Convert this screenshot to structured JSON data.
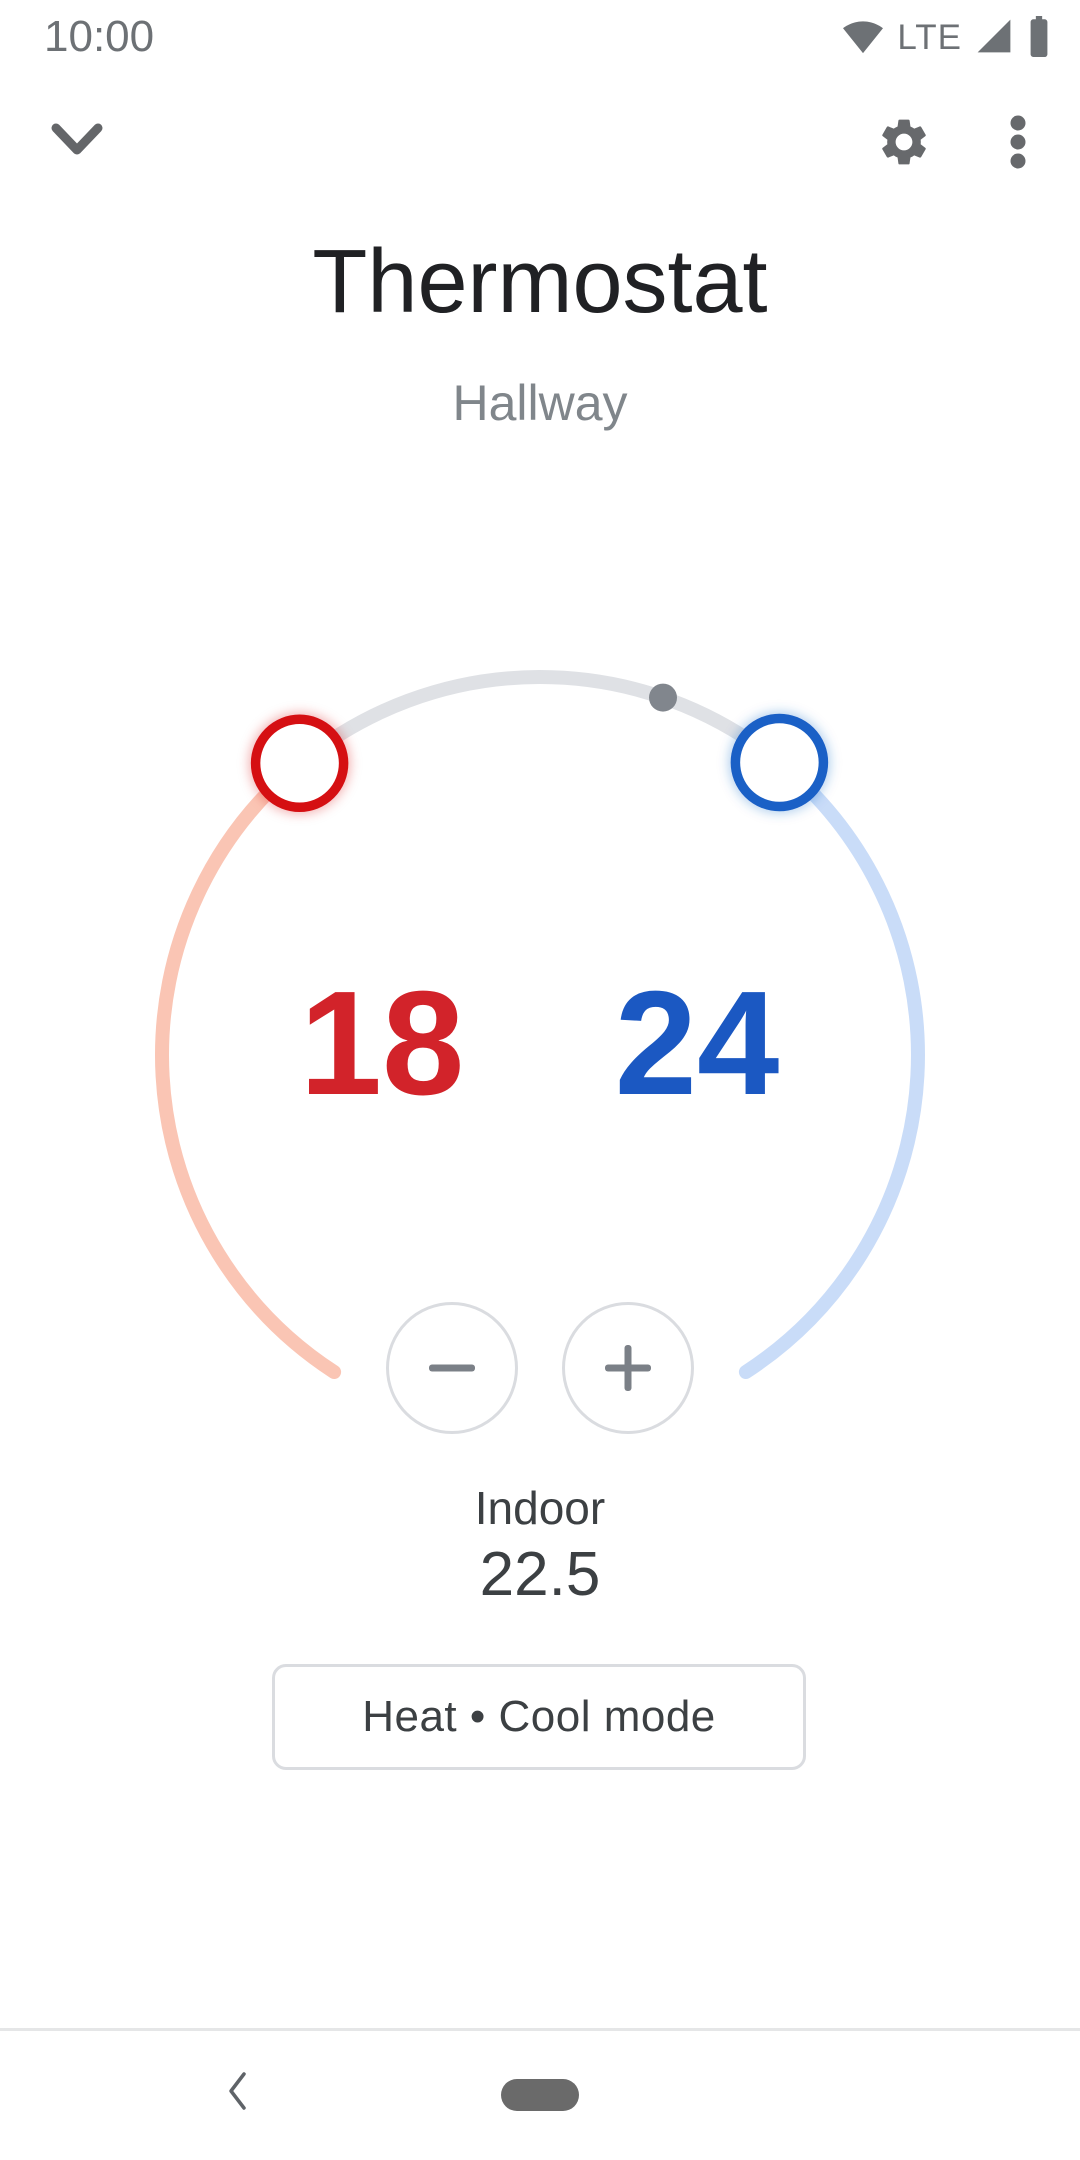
{
  "status_bar": {
    "time": "10:00",
    "network_type": "LTE",
    "wifi_icon": "wifi-full",
    "signal_icon": "cell-signal-full",
    "battery_icon": "battery-full"
  },
  "app_bar": {
    "collapse_icon": "chevron-down",
    "settings_icon": "gear",
    "menu_icon": "kebab-menu"
  },
  "device": {
    "name": "Thermostat",
    "room": "Hallway"
  },
  "dial": {
    "heat_setpoint": "18",
    "cool_setpoint": "24",
    "current_temp_marker": "gray-dot",
    "heat_handle_icon": "heat-drag-handle",
    "cool_handle_icon": "cool-drag-handle"
  },
  "controls": {
    "decrease_icon": "minus",
    "increase_icon": "plus"
  },
  "ambient": {
    "label": "Indoor",
    "temperature": "22.5"
  },
  "mode_button": {
    "label": "Heat • Cool mode"
  },
  "nav_bar": {
    "back_icon": "chevron-left",
    "home_icon": "gesture-pill"
  },
  "colors": {
    "heat": "#d2232a",
    "heat_handle": "#d50f12",
    "cool": "#1b58c2",
    "cool_handle": "#1a60c6",
    "heat_track": "#fac5b4",
    "cool_track": "#c9dcf8",
    "idle_track": "#dfe1e5",
    "current_temp_dot": "#81868d",
    "title_text": "#202124",
    "secondary_text": "#80868b",
    "body_text": "#3c4043",
    "icon_gray": "#67696c",
    "border_gray": "#dadce0"
  }
}
